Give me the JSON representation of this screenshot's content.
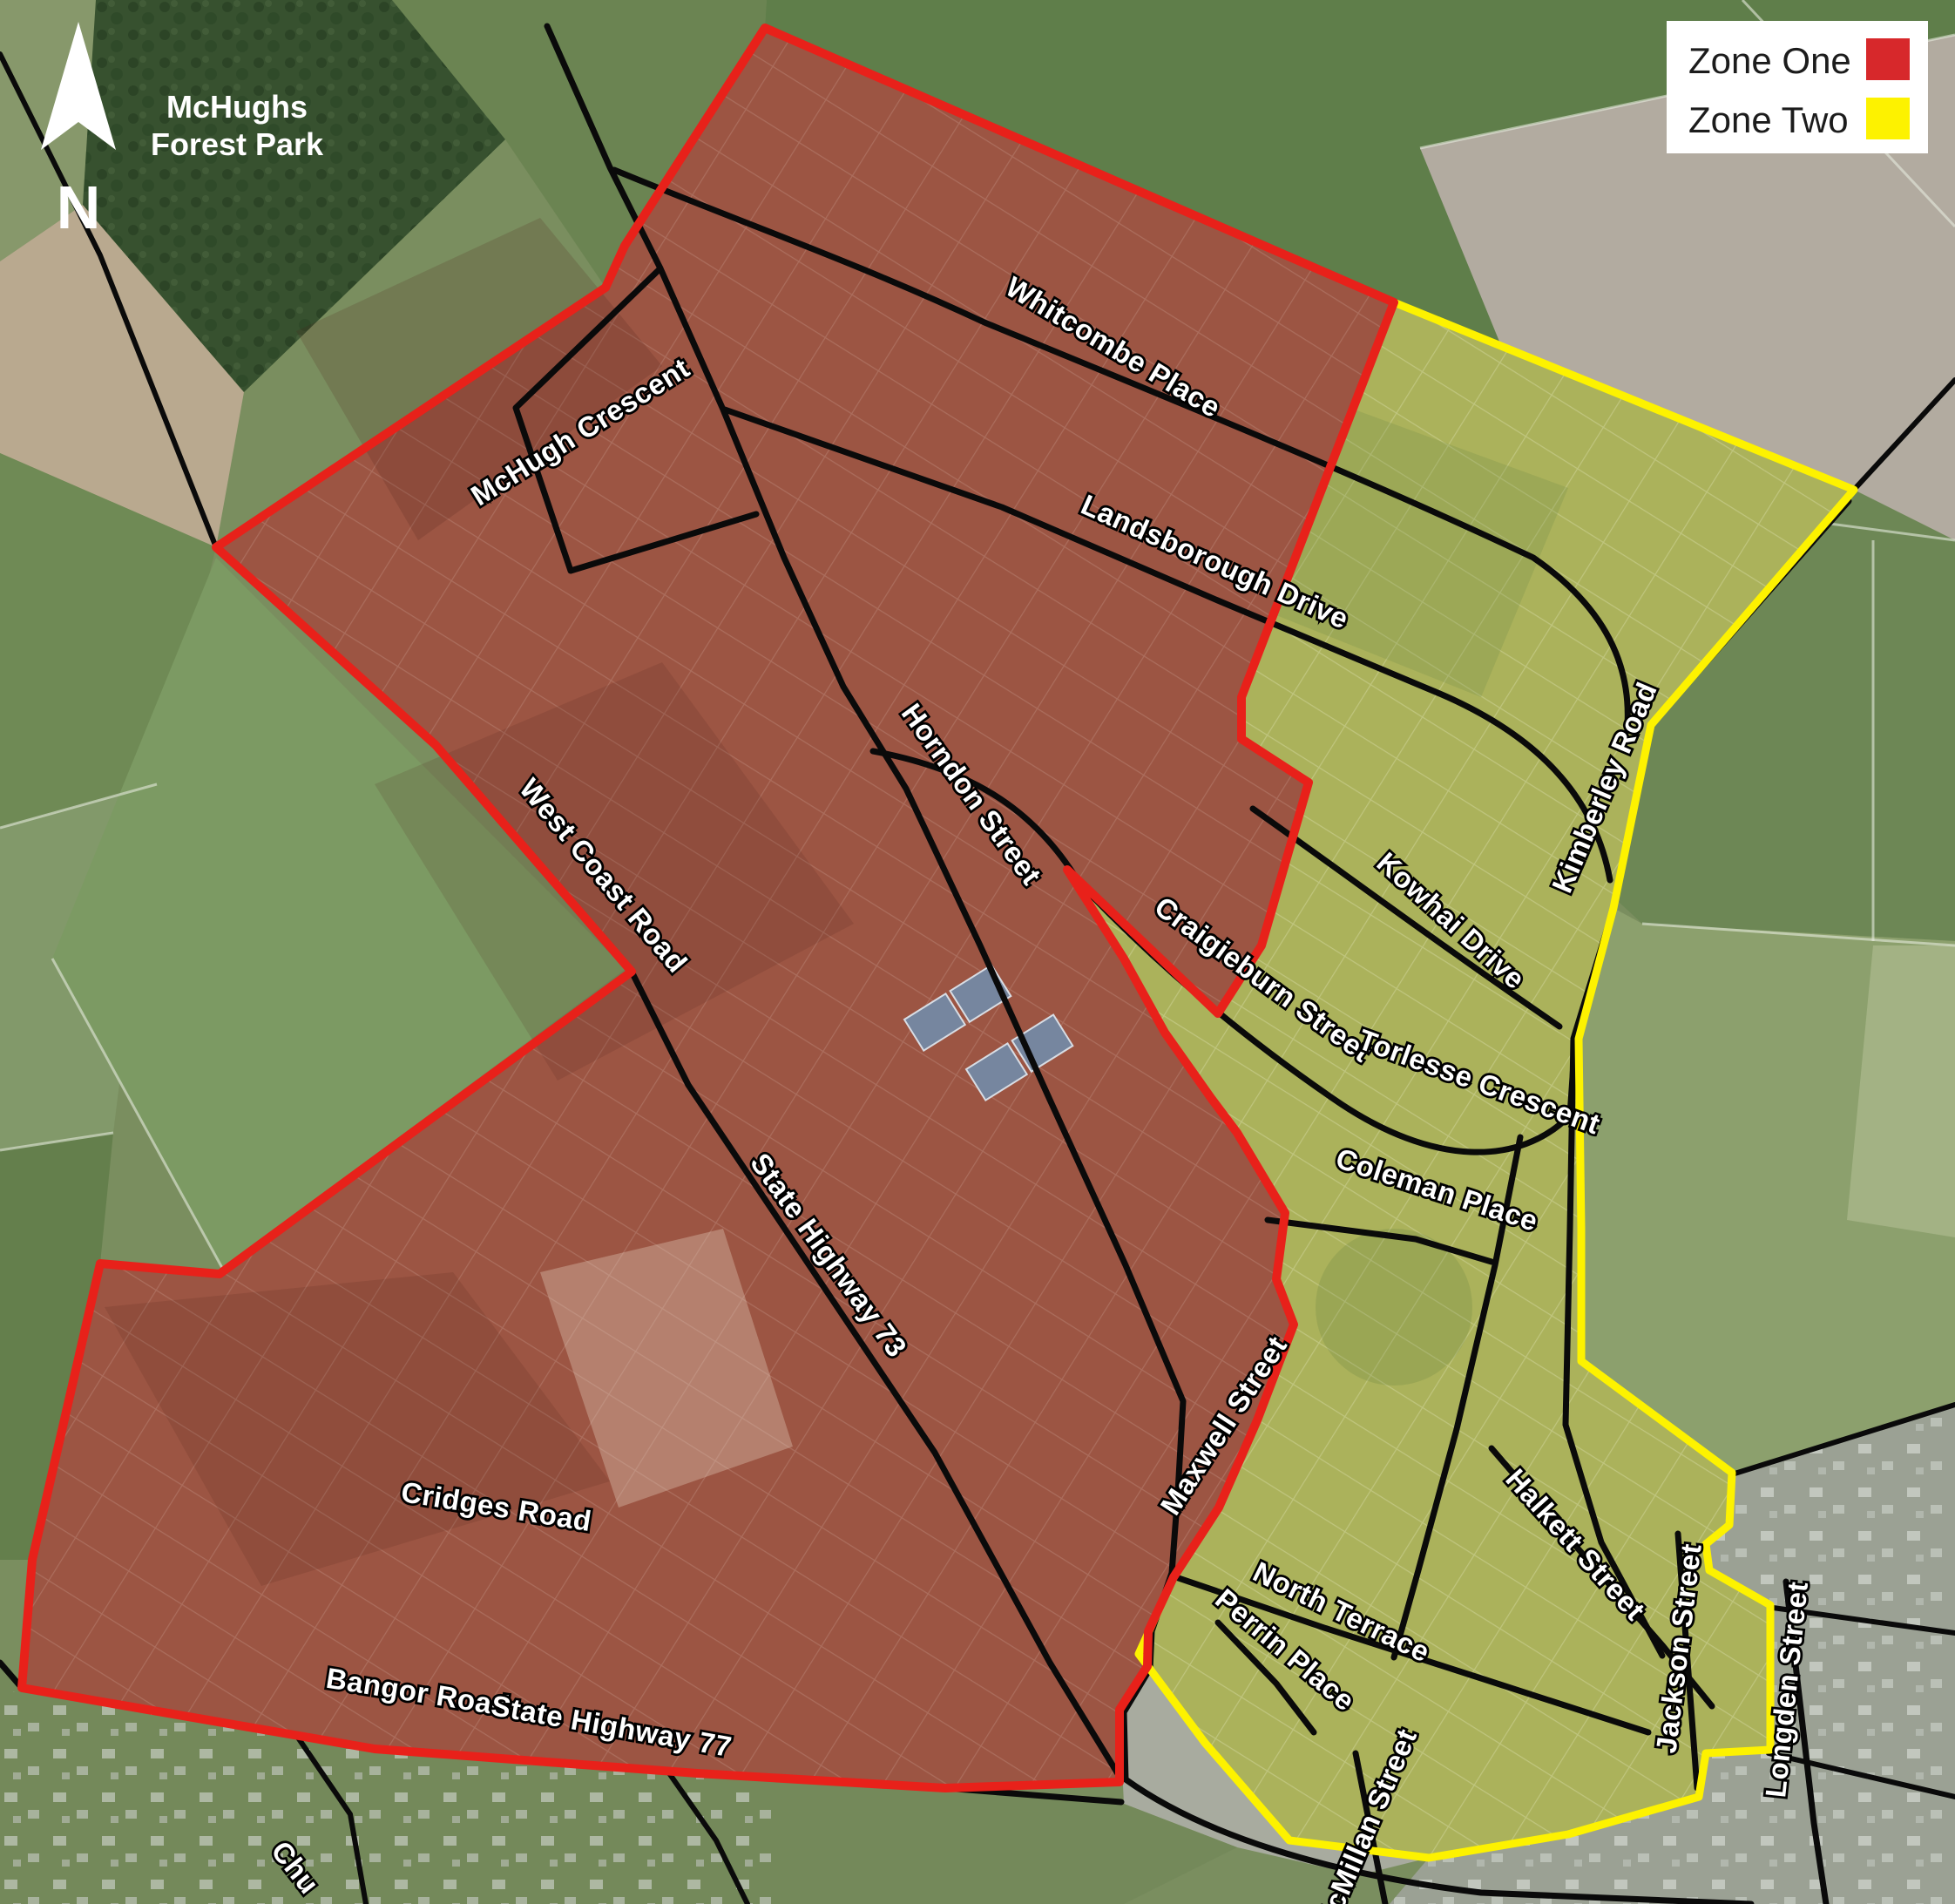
{
  "map": {
    "title": "Zoning map with aerial background",
    "north_label": "N",
    "forest_park": {
      "line1": "McHughs",
      "line2": "Forest Park"
    },
    "zones": {
      "one": {
        "label": "Zone One",
        "border_color": "#e8211a",
        "fill_base": "#8f6350",
        "fill_tint": "rgba(205,35,25,0.22)"
      },
      "two": {
        "label": "Zone Two",
        "border_color": "#fdf200",
        "fill_base": "#9aa562",
        "fill_tint": "rgba(250,240,60,0.18)"
      }
    },
    "streets": {
      "whitcombe": "Whitcombe Place",
      "landsborough": "Landsborough Drive",
      "mchugh": "McHugh Crescent",
      "horndon": "Horndon Street",
      "west_coast": "West Coast Road",
      "sh73": "State Highway 73",
      "kowhai": "Kowhai Drive",
      "kimberley": "Kimberley Road",
      "craigieburn": "Craigieburn Street",
      "torlesse": "Torlesse Crescent",
      "coleman": "Coleman Place",
      "maxwell": "Maxwell Street",
      "cridges": "Cridges Road",
      "bangor": "Bangor Road",
      "sh77": "State Highway 77",
      "north_terrace": "North Terrace",
      "perrin": "Perrin Place",
      "halkett": "Halkett Street",
      "jackson": "Jackson Street",
      "mcmillan": "McMillan Street",
      "longden": "Longden Street",
      "church_partial": "Chu"
    }
  },
  "legend": {
    "items": [
      {
        "label": "Zone One",
        "color": "#d7282b"
      },
      {
        "label": "Zone Two",
        "color": "#fdf200"
      }
    ]
  }
}
